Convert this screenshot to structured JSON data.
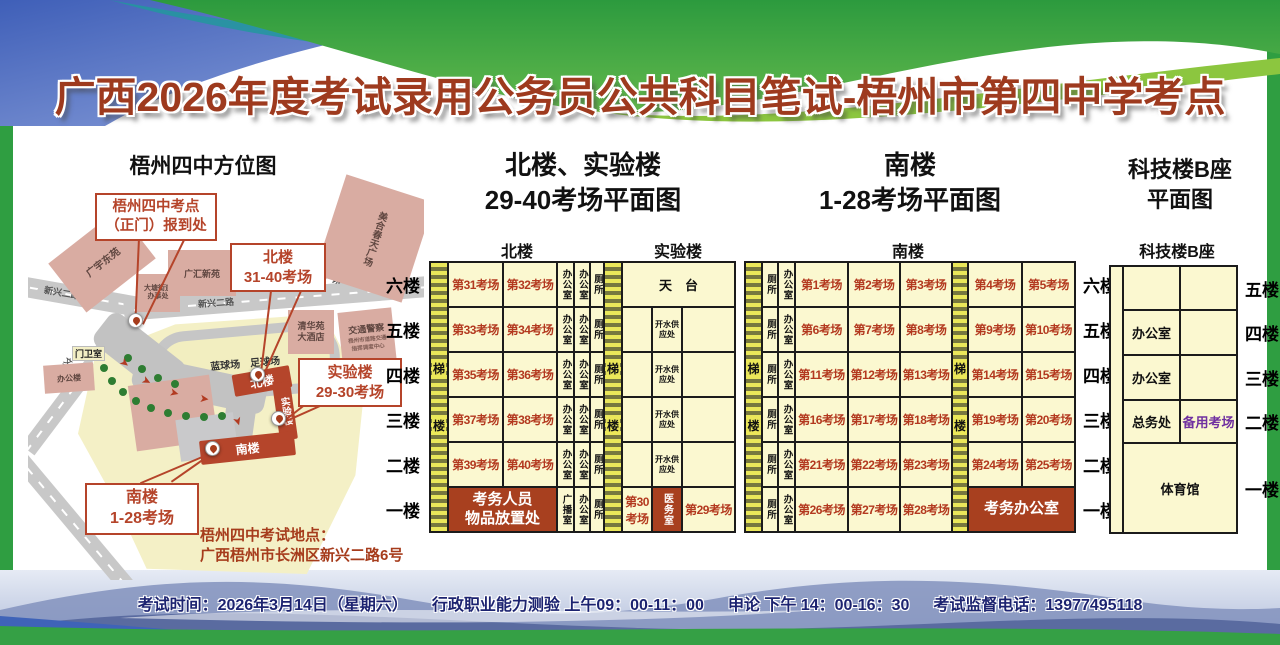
{
  "title": "广西2026年度考试录用公务员公共科目笔试-梧州市第四中学考点",
  "map": {
    "title": "梧州四中方位图",
    "callout_gate": [
      "梧州四中考点",
      "（正门）报到处"
    ],
    "callout_north": [
      "北楼",
      "31-40考场"
    ],
    "callout_lab": [
      "实验楼",
      "29-30考场"
    ],
    "callout_south": [
      "南楼",
      "1-28考场"
    ],
    "buildings": {
      "guangyu": "广宇东苑",
      "datang": [
        "大塘街道",
        "办事处"
      ],
      "guanghui": "广汇新苑",
      "meihe": "美合春天广场",
      "qinghua": [
        "清华苑",
        "大酒店"
      ],
      "jiaojing": "交通警察",
      "jiaojing_sub": [
        "梧州市道路交通",
        "指挥调度中心"
      ],
      "bangonglou": "办公楼"
    },
    "roads": {
      "xinxing_left": "新兴二路",
      "xinxing_mid": "新兴二路",
      "direction": "往太阳广场方向",
      "side": "文澜路"
    },
    "campus": {
      "gate_room": "门卫室",
      "north": "北楼",
      "lab": "实验楼",
      "south": "南楼",
      "fields": "蓝球场　足球场"
    },
    "address_label": "梧州四中考试地点：",
    "address": "广西梧州市长洲区新兴二路6号"
  },
  "plans": {
    "north_lab": {
      "title": [
        "北楼、实验楼",
        "29-40考场平面图"
      ],
      "header_north": "北楼",
      "header_lab": "实验楼",
      "floors": [
        "六楼",
        "五楼",
        "四楼",
        "三楼",
        "二楼",
        "一楼"
      ],
      "grid": {
        "columns": [
          18,
          55,
          54,
          17,
          16,
          14,
          18,
          30,
          30,
          53
        ],
        "row_height": 45,
        "stairs": [
          {
            "col": 0,
            "chars": [
              "梯",
              "楼"
            ]
          },
          {
            "col": 6,
            "chars": [
              "梯",
              "楼"
            ]
          }
        ],
        "rows": [
          [
            {
              "c": 1,
              "t": "第31考场",
              "k": "room"
            },
            {
              "c": 2,
              "t": "第32考场",
              "k": "room"
            },
            {
              "c": 3,
              "t": "办公室",
              "k": "vert"
            },
            {
              "c": 4,
              "t": "办公室",
              "k": "vert"
            },
            {
              "c": 5,
              "t": "厕所",
              "k": "vert"
            },
            {
              "c": 7,
              "t": "天　台",
              "k": "aux",
              "span": 3
            }
          ],
          [
            {
              "c": 1,
              "t": "第33考场",
              "k": "room"
            },
            {
              "c": 2,
              "t": "第34考场",
              "k": "room"
            },
            {
              "c": 3,
              "t": "办公室",
              "k": "vert"
            },
            {
              "c": 4,
              "t": "办公室",
              "k": "vert"
            },
            {
              "c": 5,
              "t": "厕所",
              "k": "vert"
            },
            {
              "c": 7,
              "t": "",
              "k": "empty"
            },
            {
              "c": 8,
              "lines": [
                "开水供",
                "应处"
              ],
              "k": "small"
            },
            {
              "c": 9,
              "t": "",
              "k": "empty"
            }
          ],
          [
            {
              "c": 1,
              "t": "第35考场",
              "k": "room"
            },
            {
              "c": 2,
              "t": "第36考场",
              "k": "room"
            },
            {
              "c": 3,
              "t": "办公室",
              "k": "vert"
            },
            {
              "c": 4,
              "t": "办公室",
              "k": "vert"
            },
            {
              "c": 5,
              "t": "厕所",
              "k": "vert"
            },
            {
              "c": 7,
              "t": "",
              "k": "empty"
            },
            {
              "c": 8,
              "lines": [
                "开水供",
                "应处"
              ],
              "k": "small"
            },
            {
              "c": 9,
              "t": "",
              "k": "empty"
            }
          ],
          [
            {
              "c": 1,
              "t": "第37考场",
              "k": "room"
            },
            {
              "c": 2,
              "t": "第38考场",
              "k": "room"
            },
            {
              "c": 3,
              "t": "办公室",
              "k": "vert"
            },
            {
              "c": 4,
              "t": "办公室",
              "k": "vert"
            },
            {
              "c": 5,
              "t": "厕所",
              "k": "vert"
            },
            {
              "c": 7,
              "t": "",
              "k": "empty"
            },
            {
              "c": 8,
              "lines": [
                "开水供",
                "应处"
              ],
              "k": "small"
            },
            {
              "c": 9,
              "t": "",
              "k": "empty"
            }
          ],
          [
            {
              "c": 1,
              "t": "第39考场",
              "k": "room"
            },
            {
              "c": 2,
              "t": "第40考场",
              "k": "room"
            },
            {
              "c": 3,
              "t": "办公室",
              "k": "vert"
            },
            {
              "c": 4,
              "t": "办公室",
              "k": "vert"
            },
            {
              "c": 5,
              "t": "厕所",
              "k": "vert"
            },
            {
              "c": 7,
              "t": "",
              "k": "empty"
            },
            {
              "c": 8,
              "lines": [
                "开水供",
                "应处"
              ],
              "k": "small"
            },
            {
              "c": 9,
              "t": "",
              "k": "empty"
            }
          ],
          [
            {
              "c": 1,
              "lines": [
                "考务人员",
                "物品放置处"
              ],
              "k": "red",
              "span": 2
            },
            {
              "c": 3,
              "t": "广播室",
              "k": "vert"
            },
            {
              "c": 4,
              "t": "办公室",
              "k": "vert"
            },
            {
              "c": 5,
              "t": "厕所",
              "k": "vert"
            },
            {
              "c": 7,
              "t": "第30考场",
              "k": "room"
            },
            {
              "c": 8,
              "t": "医务室",
              "k": "redvert"
            },
            {
              "c": 9,
              "t": "第29考场",
              "k": "room"
            }
          ]
        ]
      }
    },
    "south": {
      "title": [
        "南楼",
        "1-28考场平面图"
      ],
      "header": "南楼",
      "floors": [
        "六楼",
        "五楼",
        "四楼",
        "三楼",
        "二楼",
        "一楼"
      ],
      "grid": {
        "columns": [
          17,
          16,
          17,
          53,
          52,
          52,
          16,
          54,
          53
        ],
        "row_height": 45,
        "stairs": [
          {
            "col": 0,
            "chars": [
              "梯",
              "楼"
            ]
          },
          {
            "col": 6,
            "chars": [
              "梯",
              "楼"
            ]
          }
        ],
        "rows": [
          [
            {
              "c": 1,
              "t": "厕所",
              "k": "vert"
            },
            {
              "c": 2,
              "t": "办公室",
              "k": "vert"
            },
            {
              "c": 3,
              "t": "第1考场",
              "k": "room"
            },
            {
              "c": 4,
              "t": "第2考场",
              "k": "room"
            },
            {
              "c": 5,
              "t": "第3考场",
              "k": "room"
            },
            {
              "c": 7,
              "t": "第4考场",
              "k": "room"
            },
            {
              "c": 8,
              "t": "第5考场",
              "k": "room"
            }
          ],
          [
            {
              "c": 1,
              "t": "厕所",
              "k": "vert"
            },
            {
              "c": 2,
              "t": "办公室",
              "k": "vert"
            },
            {
              "c": 3,
              "t": "第6考场",
              "k": "room"
            },
            {
              "c": 4,
              "t": "第7考场",
              "k": "room"
            },
            {
              "c": 5,
              "t": "第8考场",
              "k": "room"
            },
            {
              "c": 7,
              "t": "第9考场",
              "k": "room"
            },
            {
              "c": 8,
              "t": "第10考场",
              "k": "room"
            }
          ],
          [
            {
              "c": 1,
              "t": "厕所",
              "k": "vert"
            },
            {
              "c": 2,
              "t": "办公室",
              "k": "vert"
            },
            {
              "c": 3,
              "t": "第11考场",
              "k": "room"
            },
            {
              "c": 4,
              "t": "第12考场",
              "k": "room"
            },
            {
              "c": 5,
              "t": "第13考场",
              "k": "room"
            },
            {
              "c": 7,
              "t": "第14考场",
              "k": "room"
            },
            {
              "c": 8,
              "t": "第15考场",
              "k": "room"
            }
          ],
          [
            {
              "c": 1,
              "t": "厕所",
              "k": "vert"
            },
            {
              "c": 2,
              "t": "办公室",
              "k": "vert"
            },
            {
              "c": 3,
              "t": "第16考场",
              "k": "room"
            },
            {
              "c": 4,
              "t": "第17考场",
              "k": "room"
            },
            {
              "c": 5,
              "t": "第18考场",
              "k": "room"
            },
            {
              "c": 7,
              "t": "第19考场",
              "k": "room"
            },
            {
              "c": 8,
              "t": "第20考场",
              "k": "room"
            }
          ],
          [
            {
              "c": 1,
              "t": "厕所",
              "k": "vert"
            },
            {
              "c": 2,
              "t": "办公室",
              "k": "vert"
            },
            {
              "c": 3,
              "t": "第21考场",
              "k": "room"
            },
            {
              "c": 4,
              "t": "第22考场",
              "k": "room"
            },
            {
              "c": 5,
              "t": "第23考场",
              "k": "room"
            },
            {
              "c": 7,
              "t": "第24考场",
              "k": "room"
            },
            {
              "c": 8,
              "t": "第25考场",
              "k": "room"
            }
          ],
          [
            {
              "c": 1,
              "t": "厕所",
              "k": "vert"
            },
            {
              "c": 2,
              "t": "办公室",
              "k": "vert"
            },
            {
              "c": 3,
              "t": "第26考场",
              "k": "room"
            },
            {
              "c": 4,
              "t": "第27考场",
              "k": "room"
            },
            {
              "c": 5,
              "t": "第28考场",
              "k": "room"
            },
            {
              "c": 7,
              "t": "考务办公室",
              "k": "red",
              "span": 2
            }
          ]
        ]
      }
    },
    "tech": {
      "title": [
        "科技楼B座",
        "平面图"
      ],
      "header": "科技楼B座",
      "floors": [
        "五楼",
        "四楼",
        "三楼",
        "二楼",
        "一楼"
      ],
      "grid": {
        "columns": [
          13,
          57,
          57
        ],
        "row_heights": [
          44,
          45,
          45,
          43,
          90
        ],
        "plain_cols": [
          0
        ],
        "stairs": [],
        "rows": [
          [
            {
              "c": 1,
              "t": "",
              "k": "empty"
            },
            {
              "c": 2,
              "t": "",
              "k": "empty"
            }
          ],
          [
            {
              "c": 1,
              "t": "办公室",
              "k": "aux"
            },
            {
              "c": 2,
              "t": "",
              "k": "empty"
            }
          ],
          [
            {
              "c": 1,
              "t": "办公室",
              "k": "aux"
            },
            {
              "c": 2,
              "t": "",
              "k": "empty"
            }
          ],
          [
            {
              "c": 1,
              "t": "总务处",
              "k": "aux"
            },
            {
              "c": 2,
              "t": "备用考场",
              "k": "purple"
            }
          ],
          [
            {
              "c": 1,
              "t": "体育馆",
              "k": "aux",
              "span": 2
            }
          ]
        ]
      }
    }
  },
  "footer": {
    "part1": "考试时间：2026年3月14日（星期六）",
    "part2": "行政职业能力测验 上午09：00-11：00",
    "part3": "申论 下午 14：00-16：30",
    "part4": "考试监督电话：13977495118"
  }
}
